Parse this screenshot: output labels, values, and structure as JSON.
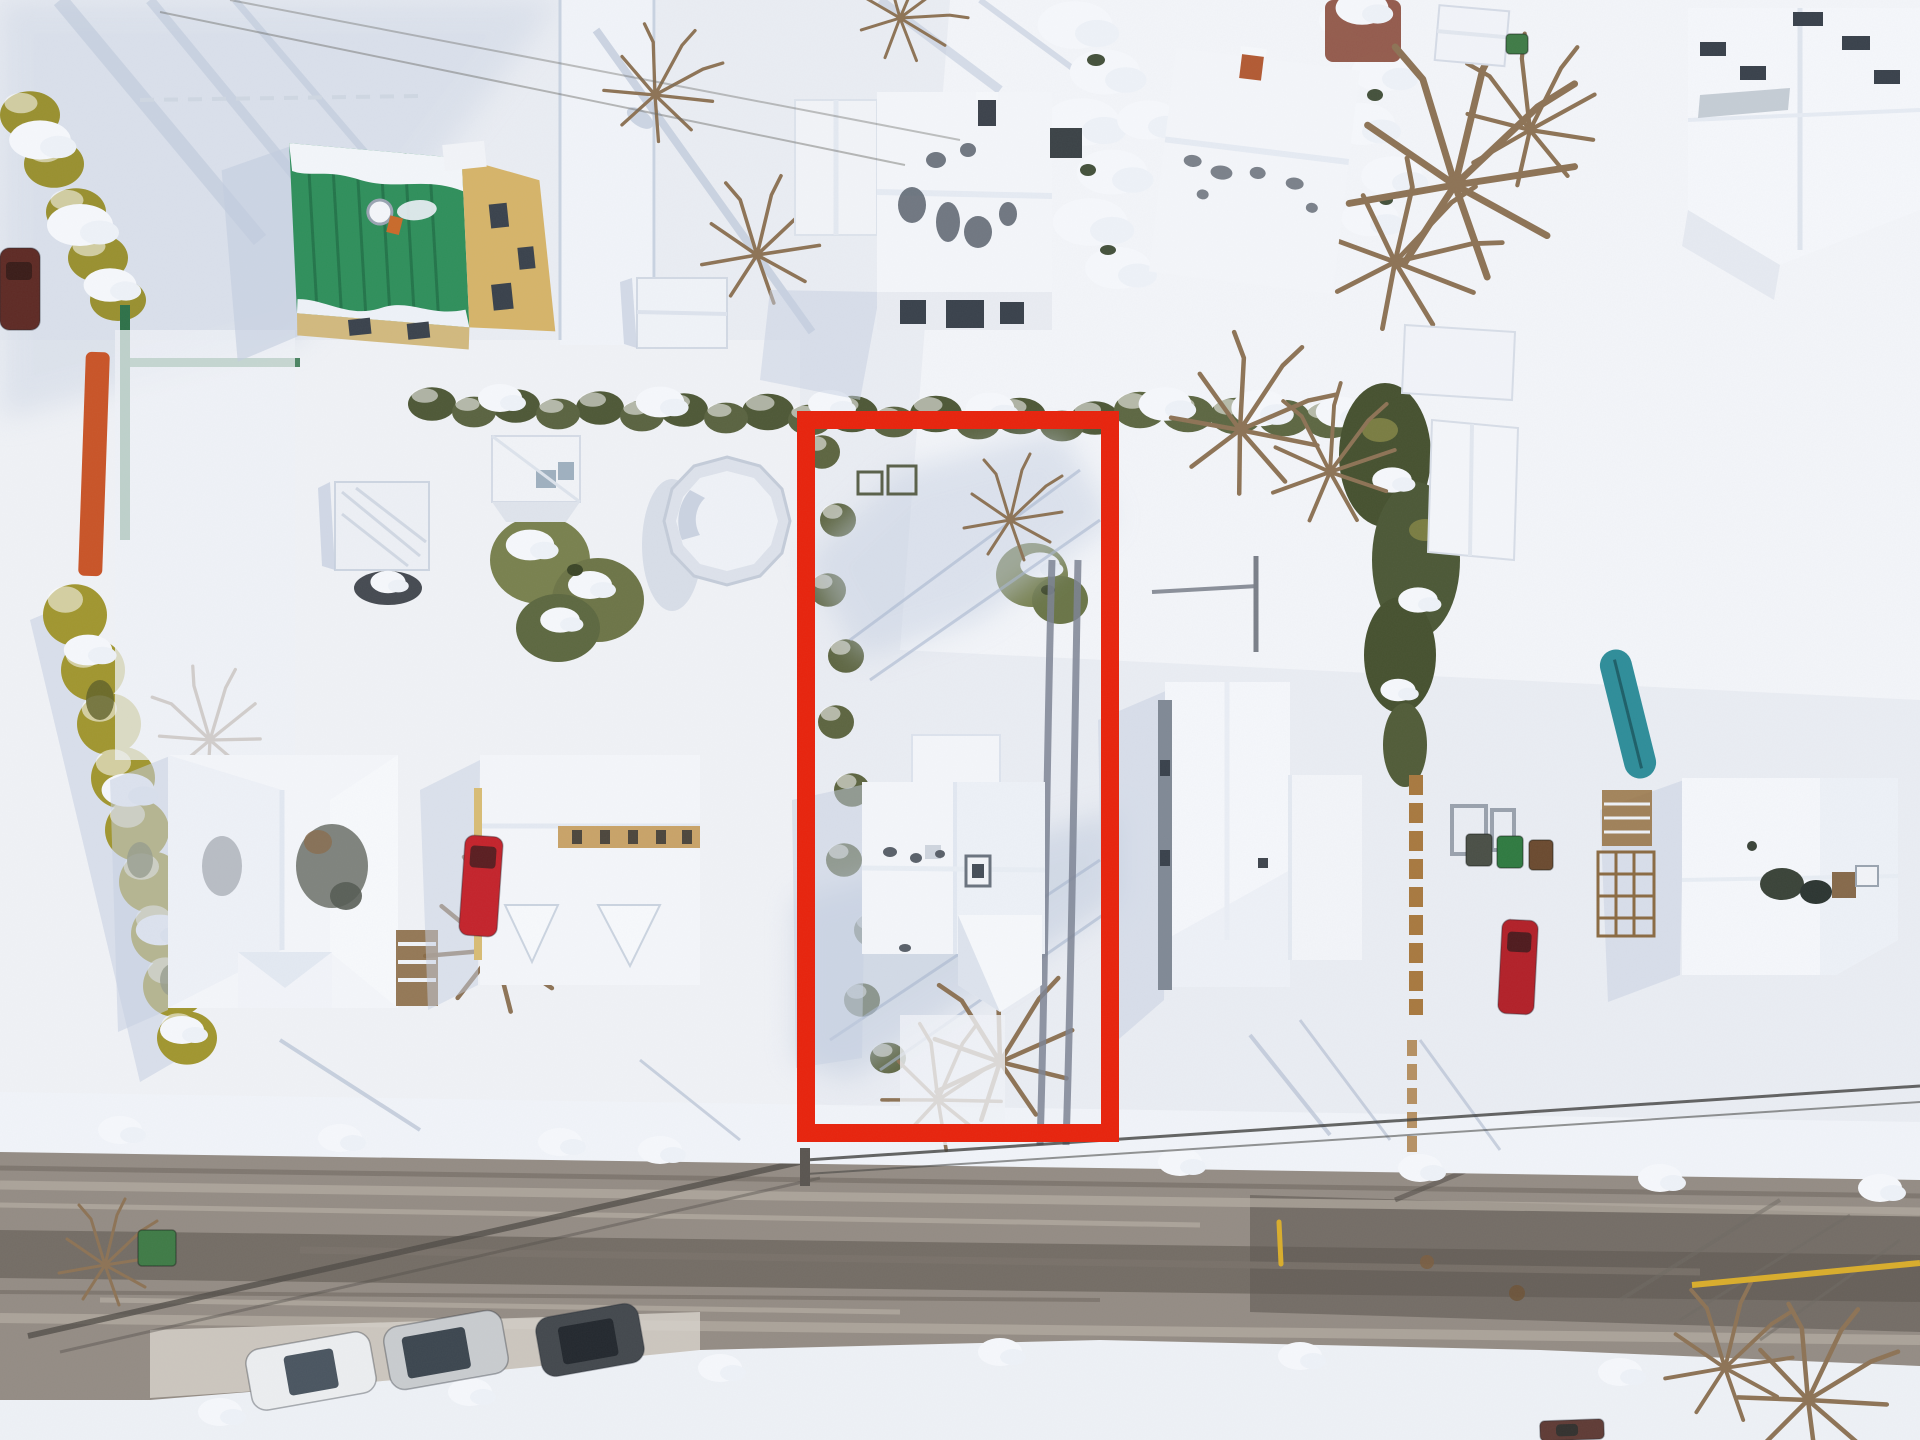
{
  "scene": {
    "kind": "aerial-winter-neighborhood-photo",
    "width": 1920,
    "height": 1440
  },
  "palette": {
    "snow": "#eaedf3",
    "snow_bright": "#f8fafd",
    "snow_mid": "#dde4ee",
    "shadow": "#b9c4d7",
    "shadow_deep": "#9fadc6",
    "road": "#948c84",
    "road_light": "#b6ada2",
    "road_dark": "#6e675f",
    "road_wet": "#5f5952",
    "hedge_green": "#4e5836",
    "hedge_yellow": "#a1962f",
    "hedge_dark": "#3c4627",
    "evergreen": "#79814e",
    "roof_white": "#f4f6fa",
    "roof_shade": "#e7ecf3",
    "roof_patch": "#646b74",
    "roof_green": "#2f8f5b",
    "roof_green_dark": "#1f6b44",
    "wall_yellow": "#d6b469",
    "wall_tan": "#c9a368",
    "wood": "#8a6a45",
    "window": "#3a424c",
    "wall_gray": "#808995",
    "wire": "#4a4a46",
    "highlight_red": "#e8230c",
    "road_line_yellow": "#d9ad2b",
    "teal": "#2e8d99",
    "tarp_orange": "#c95427",
    "fence_green": "#2e7148"
  },
  "highlight": {
    "x": 806,
    "y": 420,
    "width": 304,
    "height": 713,
    "stroke_width": 18
  },
  "vehicles": [
    {
      "name": "white-sedan-parked",
      "x": 248,
      "y": 1340,
      "width": 126,
      "height": 62,
      "rotation": -10,
      "color": "#eceef0",
      "glass": {
        "x": 286,
        "y": 1352,
        "width": 50,
        "height": 40,
        "color": "#4a5560"
      }
    },
    {
      "name": "silver-suv-parked",
      "x": 386,
      "y": 1318,
      "width": 120,
      "height": 64,
      "rotation": -10,
      "color": "#c9cccf",
      "glass": {
        "x": 404,
        "y": 1330,
        "width": 64,
        "height": 42,
        "color": "#3c464f"
      }
    },
    {
      "name": "dark-suv-parked",
      "x": 538,
      "y": 1310,
      "width": 104,
      "height": 60,
      "rotation": -10,
      "color": "#43484d",
      "glass": {
        "x": 560,
        "y": 1322,
        "width": 56,
        "height": 38,
        "color": "#23282e"
      }
    },
    {
      "name": "red-minivan-driveway",
      "x": 462,
      "y": 836,
      "width": 38,
      "height": 100,
      "rotation": 4,
      "color": "#c4232b",
      "glass": {
        "x": 468,
        "y": 846,
        "width": 26,
        "height": 22,
        "color": "#5a1d20"
      }
    },
    {
      "name": "red-car-east-driveway",
      "x": 1500,
      "y": 920,
      "width": 36,
      "height": 94,
      "rotation": 3,
      "color": "#b22028",
      "glass": {
        "x": 1506,
        "y": 932,
        "width": 24,
        "height": 20,
        "color": "#4f1a1d"
      }
    },
    {
      "name": "car-bottom-edge",
      "x": 1540,
      "y": 1420,
      "width": 64,
      "height": 20,
      "rotation": -2,
      "color": "#5f3b35",
      "glass": {
        "x": 1556,
        "y": 1424,
        "width": 22,
        "height": 12,
        "color": "#33312e"
      }
    },
    {
      "name": "car-left-edge",
      "x": 0,
      "y": 248,
      "width": 40,
      "height": 82,
      "rotation": 0,
      "color": "#5e2a24",
      "glass": {
        "x": 6,
        "y": 262,
        "width": 26,
        "height": 18,
        "color": "#3a1c18"
      }
    }
  ],
  "objects": {
    "canoe": {
      "x": 1612,
      "y": 648,
      "width": 32,
      "height": 132,
      "rotation": -14,
      "color": "#2e8d99"
    },
    "tarp": {
      "x": 82,
      "y": 352,
      "width": 24,
      "height": 224,
      "rotation": 2,
      "color": "#c95427"
    },
    "bins": [
      {
        "x": 138,
        "y": 1230,
        "width": 38,
        "height": 36,
        "color": "#3f7b46"
      },
      {
        "x": 1466,
        "y": 834,
        "width": 26,
        "height": 32,
        "color": "#4a4f46"
      },
      {
        "x": 1497,
        "y": 836,
        "width": 26,
        "height": 32,
        "color": "#2f7a40"
      },
      {
        "x": 1529,
        "y": 840,
        "width": 24,
        "height": 30,
        "color": "#6b4a2f"
      },
      {
        "x": 1506,
        "y": 34,
        "width": 22,
        "height": 20,
        "color": "#3f7b46"
      }
    ],
    "manholes": [
      {
        "cx": 1427,
        "cy": 1262,
        "r": 7,
        "color": "#7a5e41"
      },
      {
        "cx": 1517,
        "cy": 1293,
        "r": 8,
        "color": "#6e5438"
      }
    ],
    "yellow_line": {
      "x1": 1692,
      "y1": 1285,
      "x2": 1920,
      "y2": 1263,
      "width": 6
    },
    "marker_pole": {
      "x1": 1279,
      "y1": 1222,
      "x2": 1281,
      "y2": 1264,
      "width": 5,
      "color": "#d9ad2b"
    }
  }
}
